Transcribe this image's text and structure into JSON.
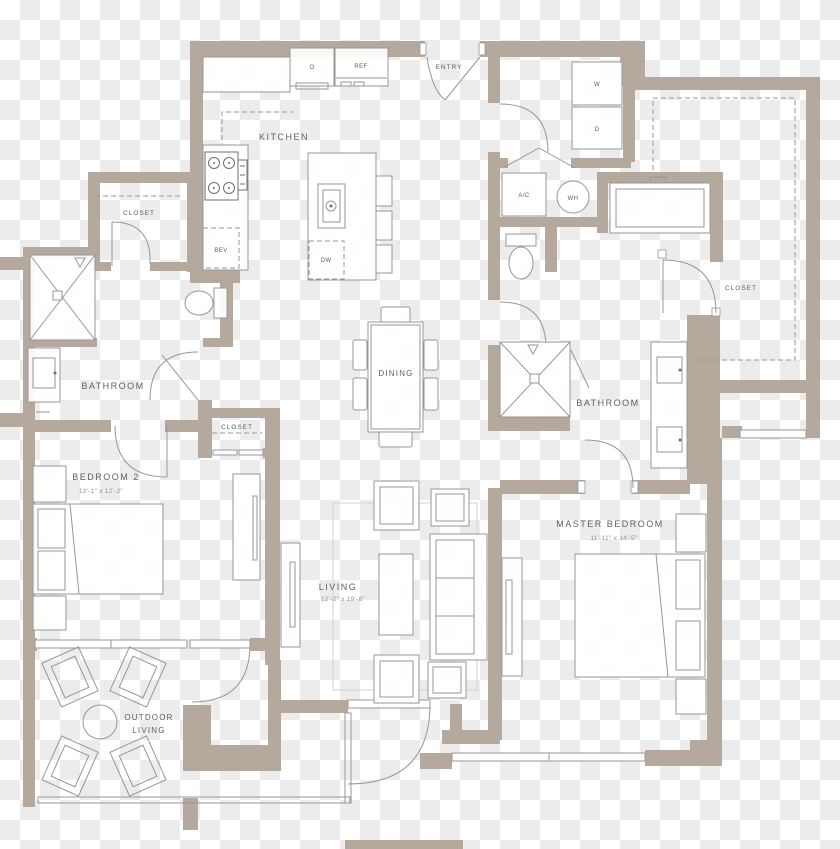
{
  "floorplan": {
    "rooms": {
      "kitchen": {
        "label": "KITCHEN"
      },
      "entry": {
        "label": "ENTRY"
      },
      "dining": {
        "label": "DINING"
      },
      "living": {
        "label": "LIVING",
        "dimensions": "12'-2\" x 19'-6\""
      },
      "bedroom2": {
        "label": "BEDROOM 2",
        "dimensions": "13'-1\" x 12'-2\""
      },
      "master_bedroom": {
        "label": "MASTER BEDROOM",
        "dimensions": "11'-11\" x 14'-5\""
      },
      "bathroom_left": {
        "label": "BATHROOM"
      },
      "bathroom_master": {
        "label": "BATHROOM"
      },
      "closet_hall": {
        "label": "CLOSET"
      },
      "closet_middle": {
        "label": "CLOSET"
      },
      "closet_master": {
        "label": "CLOSET"
      },
      "outdoor_living": {
        "label_line1": "OUTDOOR",
        "label_line2": "LIVING"
      }
    },
    "fixtures": {
      "oven": "O",
      "refrigerator": "REF",
      "dishwasher": "DW",
      "beverage_center": "BEV",
      "washer": "W",
      "dryer": "D",
      "ac_unit": "A/C",
      "water_heater": "WH"
    },
    "colors": {
      "wall": "#b4a99c",
      "line": "#979797",
      "text": "#606060",
      "text_dim": "#8e8e8e",
      "fill": "#ffffff",
      "checker_light": "#ffffff",
      "checker_dark": "#ececec"
    }
  }
}
